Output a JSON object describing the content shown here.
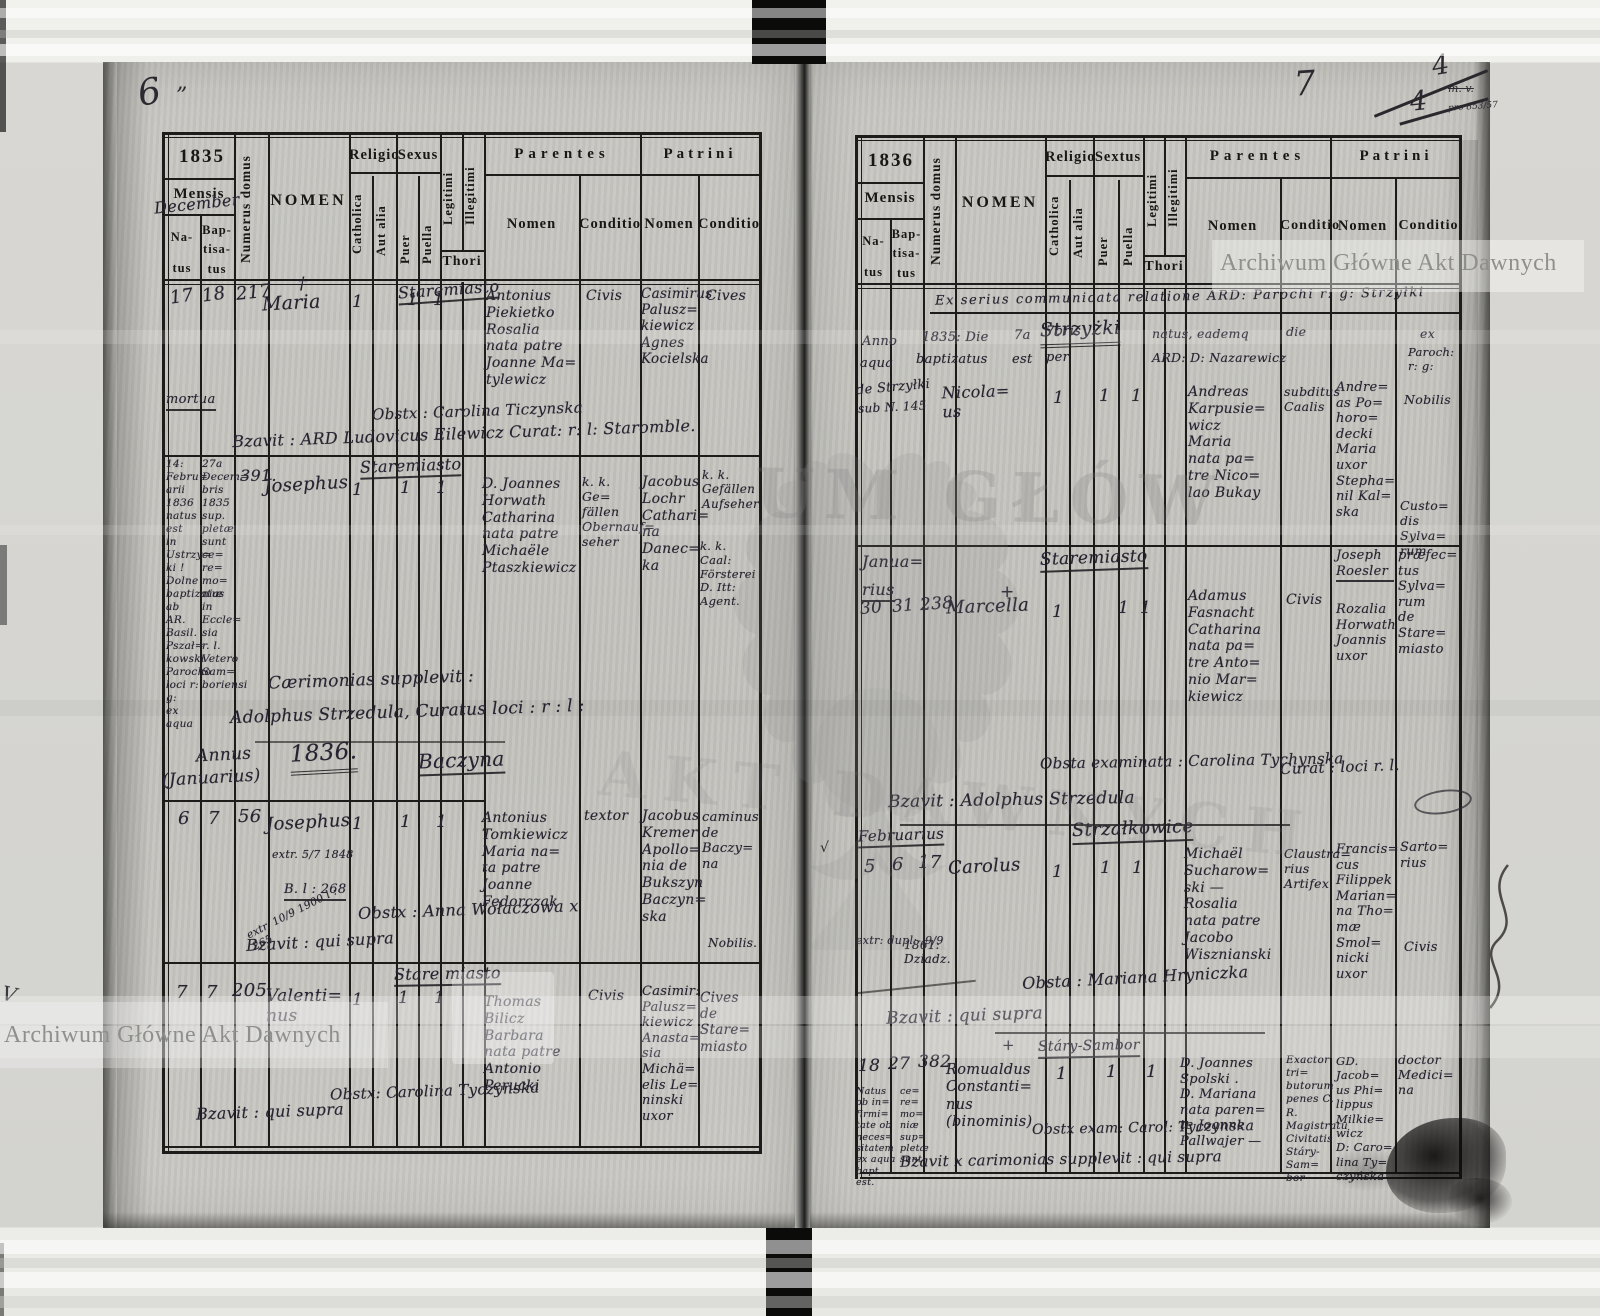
{
  "labels": {
    "year_left": "1835",
    "year_right": "1836",
    "mensis": "Mensis",
    "december": "December",
    "natus": "Na-\ntus",
    "baptisatus": "Bap-\ntisa-\ntus",
    "numerus_domus": "Numerus domus",
    "nomen_caps": "NOMEN",
    "religio": "Religio",
    "catholica": "Catholica",
    "aut_alia": "Aut alia",
    "sexus": "Sexus",
    "sextus": "Sextus",
    "puer": "Puer",
    "puella": "Puella",
    "legitimi": "Legitimi",
    "illegitimi": "Illegitimi",
    "thori": "Thori",
    "parentes": "Parentes",
    "patrini": "Patrini",
    "nomen": "Nomen",
    "conditio": "Conditio"
  },
  "watermarks": {
    "agad": "Archiwum Główne Akt Dawnych",
    "ghost_top": "UM GŁÓW",
    "ghost_bottom": "AKT DAWNYCH"
  },
  "annotations": {
    "page_left": "6",
    "page_left_mark": "”",
    "page_right": "7",
    "mark_a": "4",
    "mark_b": "4",
    "mv_note": "m. v.",
    "tiny_note": "pro 853/57",
    "left_check": "V",
    "margin_check": "√"
  },
  "left": {
    "e1": {
      "natus": "17",
      "baptisatus": "18",
      "numerus": "217",
      "cross": "†",
      "nomen": "Maria",
      "mortua": "mortua",
      "place": "Staremiasto",
      "cath": "1",
      "puella": "1",
      "legit": "1",
      "parentes": "Antonius\nPiekietko\nRosalia\nnata patre\nJoanne Ma=\ntylewicz",
      "par_cond": "Civis",
      "patrini": "Casimirus\nPalusz=\nkiewicz\nAgnes\nKocielska",
      "patr_cond": "Cives",
      "obstetrix": "Obstx : Carolina Ticzynska",
      "baptizavit": "Bzavit : ARD Ludovicus Eilewicz Curat: r: l: Staromble."
    },
    "e2": {
      "natus_note": "14:\nFebru=\narii\n1836\nnatus\nest\nin\nUstrzy=\nki !\nDolne\nbaptizatus\nab AR.\nBasil.\nPszał=\nkowski\nParocho\nloci r: g:\nex aqua",
      "bapt_note": "27a\nDecem=\nbris\n1835\nsup.\npletæ\nsunt\nce=\nre=\nmo=\nniæ\nin\nEccle=\nsia\nr. l.\nVetero\nSam=\nboriensi",
      "numerus": "391.",
      "place": "Staremiasto",
      "nomen": "Josephus",
      "cath": "1",
      "puer": "1",
      "legit": "1",
      "parentes": "D. Joannes\nHorwath\nCatharina\nnata patre\nMichaële\nPtaszkiewicz",
      "par_cond": "k. k. Ge=\nfällen\nObernauf=\nseher",
      "patrini": "Jacobus\nLochr\nCathari=\nna\nDanec=\nka",
      "patr_cond_a": "k. k.\nGefällen\nAufseher",
      "patr_cond_b": "k. k. Caal:\nFörsterei\nD. Itt:\nAgent.",
      "ceremony_1": "Cærimonias supplevit :",
      "ceremony_2": "Adolphus Strzedula, Curatus loci : r : l :"
    },
    "heading": {
      "annus": "Annus",
      "month": "(Januarius)",
      "year": "1836.",
      "place": "Baczyna"
    },
    "e3": {
      "natus": "6",
      "baptisatus": "7",
      "numerus": "56",
      "nomen": "Josephus",
      "note_1": "extr. 5/7 1848",
      "note_2": "B. l : 268",
      "note_3": "extr. 10/9 1900 l : 265",
      "cath": "1",
      "puer": "1",
      "legit": "1",
      "parentes": "Antonius\nTomkiewicz\nMaria na=\nta patre\nJoanne\nFedorczak",
      "par_cond": "textor",
      "patrini": "Jacobus\nKremer\nApollo=\nnia de\nBukszyn\nBaczyn=\nska",
      "patr_cond": "caminus\nde\nBaczy=\nna",
      "patr_cond_2": "Nobilis.",
      "obstetrix": "Obstx : Anna Wołaczowa x",
      "baptizavit": "Bzavit : qui supra"
    },
    "e4": {
      "natus": "7",
      "baptisatus": "7",
      "numerus": "205",
      "nomen": "Valenti=\nnus",
      "place": "Stare miasto",
      "cath": "1",
      "puer": "1",
      "legit": "1",
      "parentes": "Thomas\nBilicz\nBarbara\nnata patre\nAntonio\nPerucki",
      "par_cond": "Civis",
      "patrini": "Casimir:\nPalusz=\nkiewicz\nAnasta=\nsia\nMichä=\nelis Le=\nninski\nuxor",
      "patr_cond": "Cives\nde\nStare=\nmiasto",
      "obstetrix": "Obstx: Carolina Tyczynska",
      "baptizavit": "Bzavit : qui supra"
    }
  },
  "right": {
    "note_top": "Ex serius communicata relatione ARD: Parochi r: g: Strzyłki",
    "e1": {
      "place": "Strzyżki",
      "l_anno": "Anno",
      "l_1835": "1835: Die",
      "l_7a": "7a",
      "l_7bris": "7bris",
      "l_natus": "natus, eademq",
      "l_die": "die",
      "l_ex": "ex",
      "l_aqua": "aqua",
      "l_bapt": "baptizatus",
      "l_est": "est",
      "l_per": "per",
      "l_ard": "ARD: D: Nazarewicz",
      "l_paroch": "Paroch:\nr: g:",
      "l_de": "de Strzyłki",
      "l_sub": "sub N. 145",
      "nomen": "Nicola=\nus",
      "cath": "1",
      "puer": "1",
      "legit": "1",
      "parentes": "Andreas\nKarpusie=\nwicz\nMaria\nnata pa=\ntre Nico=\nlao Bukay",
      "par_cond": "subditus\nCaalis",
      "patrini": "Andre=\nas Po=\nhoro=\ndecki\nMaria\nuxor\nStepha=\nnil Kal=\nska",
      "patr_cond": "Nobilis",
      "patr_cond_2": "Custo=\ndis\nSylva=\nrum"
    },
    "e2": {
      "month_a": "Janua=",
      "month_b": "rius",
      "cross": "+",
      "natus": "30",
      "baptisatus": "31",
      "numerus": "238",
      "nomen": "Marcella",
      "place": "Staremiasto",
      "cath": "1",
      "puella": "1",
      "legit": "1",
      "parentes": "Adamus\nFasnacht\nCatharina\nnata pa=\ntre Anto=\nnio Mar=\nkiewicz",
      "par_cond": "Civis",
      "patrini_a": "Joseph\nRoesler",
      "patrini_b": "Rozalia\nHorwath\nJoannis\nuxor",
      "patr_cond": "præfec=\ntus\nSylva=\nrum\nde\nStare=\nmiasto",
      "obstetrix": "Obsta examinata : Carolina Tychynska",
      "baptizavit": "Bzavit : Adolphus Strzedula",
      "curat": "Curat : loci r. l."
    },
    "e3": {
      "month": "Februarius",
      "natus": "5",
      "baptisatus": "6",
      "numerus": "17",
      "nomen": "Carolus",
      "place": "Strzałkowice",
      "cath": "1",
      "puer": "1",
      "legit": "1",
      "parentes": "Michaël\nSucharow=\nski —\nRosalia\nnata patre\nJacobo\nWisznianski",
      "par_cond": "Claustra=\nrius\nArtifex",
      "patrini": "Francis=\ncus\nFilippek\nMarian=\nna Tho=\nmæ Smol=\nnicki\nuxor",
      "patr_cond": "Sarto=\nrius",
      "patr_cond_2": "Civis",
      "note_a": "extr: dupl:- 9/9",
      "note_b": "1861:\nDziadz.",
      "obstetrix": "Obsta : Mariana Hryniczka",
      "baptizavit": "Bzavit : qui supra"
    },
    "e4": {
      "cross": "+",
      "place": "Stáry-Sambor",
      "natus": "18",
      "baptisatus": "27",
      "numerus": "382",
      "natus_note": "Natus\nob in=\nfirmi=\ntate ob\nneces=\nsitatem\nex aqua\nbapt. est.",
      "bapt_note": "ce=\nre=\nmo=\nniæ\nsup=\npletæ\nsunt.",
      "nomen": "Romualdus\nConstanti=\nnus\n(binominis)",
      "cath": "1",
      "puer": "1",
      "legit": "1",
      "parentes": "D. Joannes\nSpolski .\nD. Mariana\nnata paren=\nte Joanne\nPallwajer —",
      "par_cond": "Exactor tri=\nbutorum\npenes C. R.\nMagistratu\nCivitatis\nStáry-Sam=\nbor",
      "patrini": "GD. Jacob=\nus Phi=\nlippus\nMilkie=\nwicz\nD: Caro=\nlina Ty=\nczyńska",
      "patr_cond": "doctor\nMedici=\nna",
      "obstetrix": "Obstx exam: Carol: Tyczynska",
      "baptizavit": "Bzavit x carimonias supplevit : qui supra"
    }
  }
}
